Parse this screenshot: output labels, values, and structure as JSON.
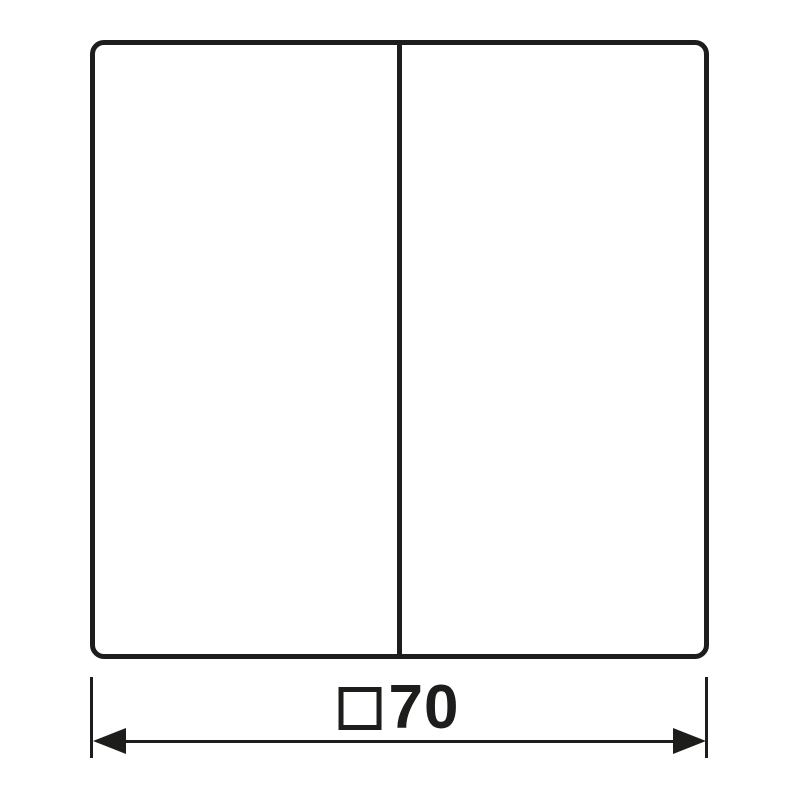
{
  "diagram": {
    "ink_color": "#1d1d1b",
    "background_color": "#ffffff",
    "plate": {
      "shape": "rounded-square",
      "sections": 2
    },
    "dimension": {
      "symbol": "□",
      "value": "70",
      "label": "□70",
      "meaning": "square 70"
    }
  }
}
